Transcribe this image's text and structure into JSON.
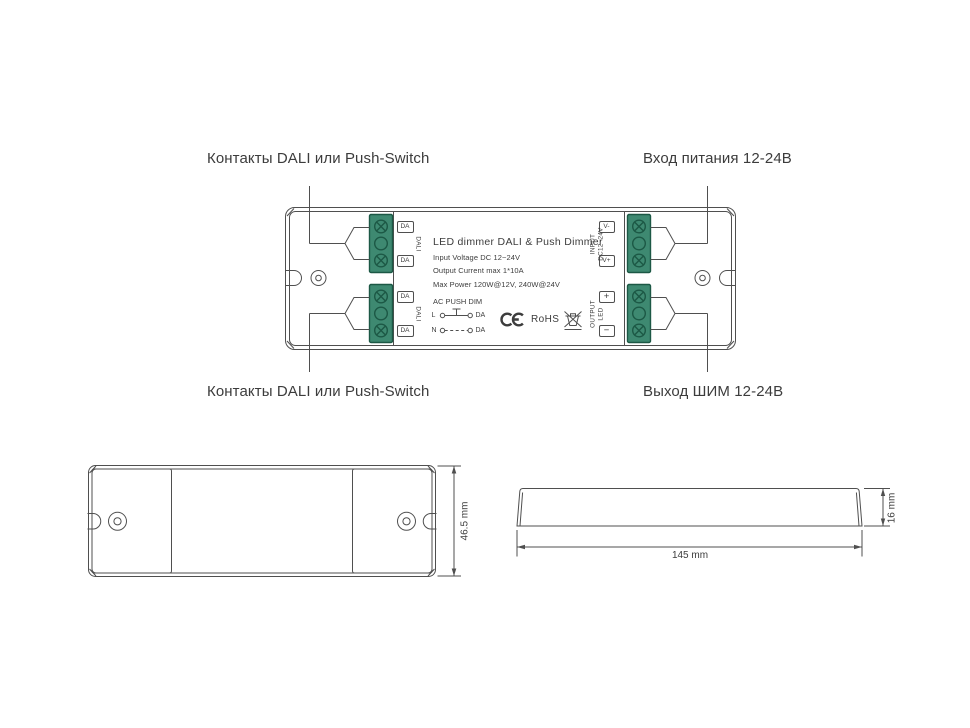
{
  "meta": {
    "background": "#ffffff"
  },
  "colors": {
    "line": "#4f4f4f",
    "text": "#3d3d3d",
    "callout_text": "#3c3c3c",
    "terminal_fill": "#3e8971",
    "terminal_border": "#1c5845"
  },
  "callouts": {
    "top_left": "Контакты DALI или Push-Switch",
    "top_right": "Вход питания 12-24В",
    "bottom_left": "Контакты DALI или Push-Switch",
    "bottom_right": "Выход ШИМ 12-24В"
  },
  "device_label": {
    "title": "LED dimmer DALI & Push Dimmer",
    "specs": [
      "Input Voltage DC 12~24V",
      "Output Current max 1*10A",
      "Max Power 120W@12V, 240W@24V"
    ],
    "wiring_diagram": {
      "heading": "AC PUSH DIM",
      "line_live": {
        "from": "L",
        "to": "DA"
      },
      "line_neutral": {
        "from": "N",
        "to": "DA"
      }
    },
    "certifications": {
      "ce_mark": "CE",
      "rohs": "RoHS",
      "weee_icon": "crossed-out-wheeled-bin"
    }
  },
  "terminals": {
    "dali_upper": {
      "label": "DALI",
      "pins": [
        "DA",
        "DA"
      ]
    },
    "dali_lower": {
      "label": "DALI",
      "pins": [
        "DA",
        "DA"
      ]
    },
    "input": {
      "label_line1": "INPUT",
      "label_line2": "DC12~24V",
      "pins": [
        "V-",
        "V+"
      ]
    },
    "output": {
      "label_line1": "OUTPUT",
      "label_line2": "LED",
      "pins": [
        "+",
        "−"
      ]
    }
  },
  "dimensions": {
    "device_height": "46.5 mm",
    "device_length": "145 mm",
    "device_depth": "16 mm"
  }
}
